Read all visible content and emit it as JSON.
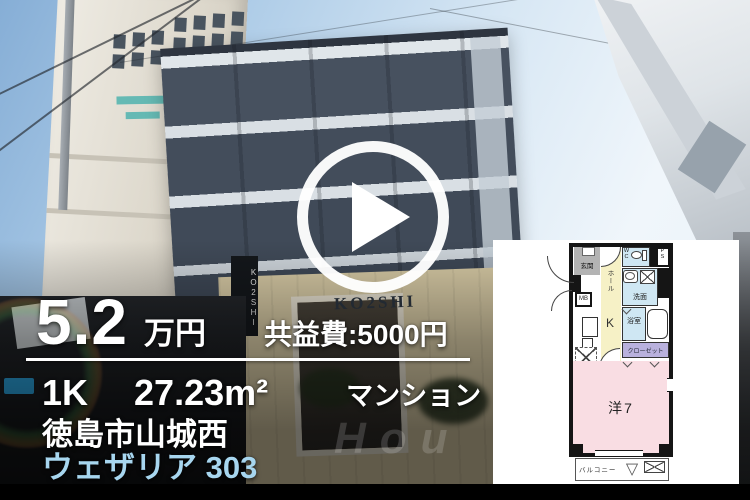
{
  "listing": {
    "price_value": "5.2",
    "price_unit": "万円",
    "common_fee": "共益費:5000円",
    "floor_layout": "1K",
    "floor_area": "27.23m²",
    "building_type": "マンション",
    "address": "徳島市山城西",
    "property_name": "ウェザリア 303"
  },
  "photo": {
    "building_sign": "KO2SHI",
    "watermark_text": "Hou"
  },
  "floorplan": {
    "labels": {
      "entrance": "玄関",
      "hall": "ホール",
      "wc": "WC",
      "ps": "PS",
      "mb": "MB",
      "washroom": "洗面",
      "kitchen": "K",
      "bathroom": "浴室",
      "closet": "クローゼット",
      "main_room": "洋7",
      "balcony": "バルコニー"
    },
    "icons": {
      "balcony_hatch_triangle": "▽"
    },
    "colors": {
      "wet_area": "#cfe7f3",
      "hall_kitchen": "#f6f1c6",
      "closet": "#b9b1dd",
      "main_room": "#f9dde3",
      "entrance_floor": "#b3b3b3",
      "wall": "#151515"
    }
  },
  "colors": {
    "overlay_text": "#ffffff",
    "property_name_text": "#a7d6ef",
    "bottom_bar": "#000000"
  }
}
